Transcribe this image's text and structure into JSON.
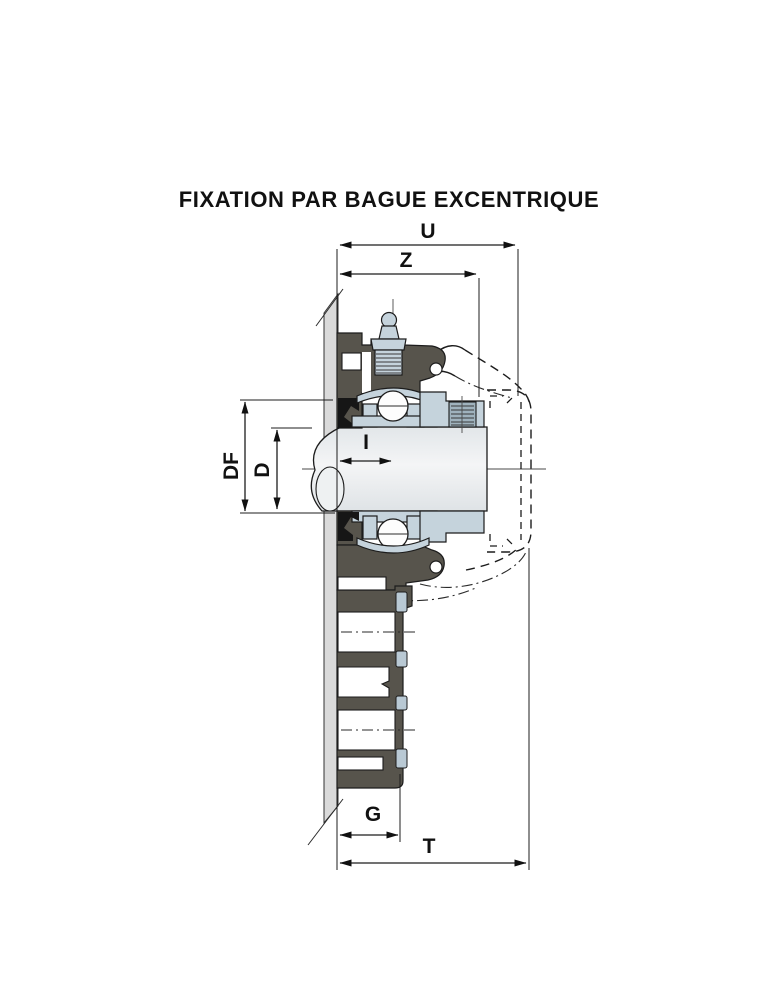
{
  "title": "FIXATION PAR BAGUE EXCENTRIQUE",
  "dimension_labels": {
    "U": "U",
    "Z": "Z",
    "DF": "DF",
    "D": "D",
    "I": "I",
    "G": "G",
    "T": "T"
  },
  "colors": {
    "housing_dark_gray": "#57544c",
    "component_steel_blue": "#c5d3dc",
    "clip_blue": "#b9c9d4",
    "seal_black": "#161616",
    "shaft_light_gray": "#e9edef",
    "wall_gray": "#dadada",
    "line_black": "#1c1c1c",
    "background": "#ffffff"
  }
}
